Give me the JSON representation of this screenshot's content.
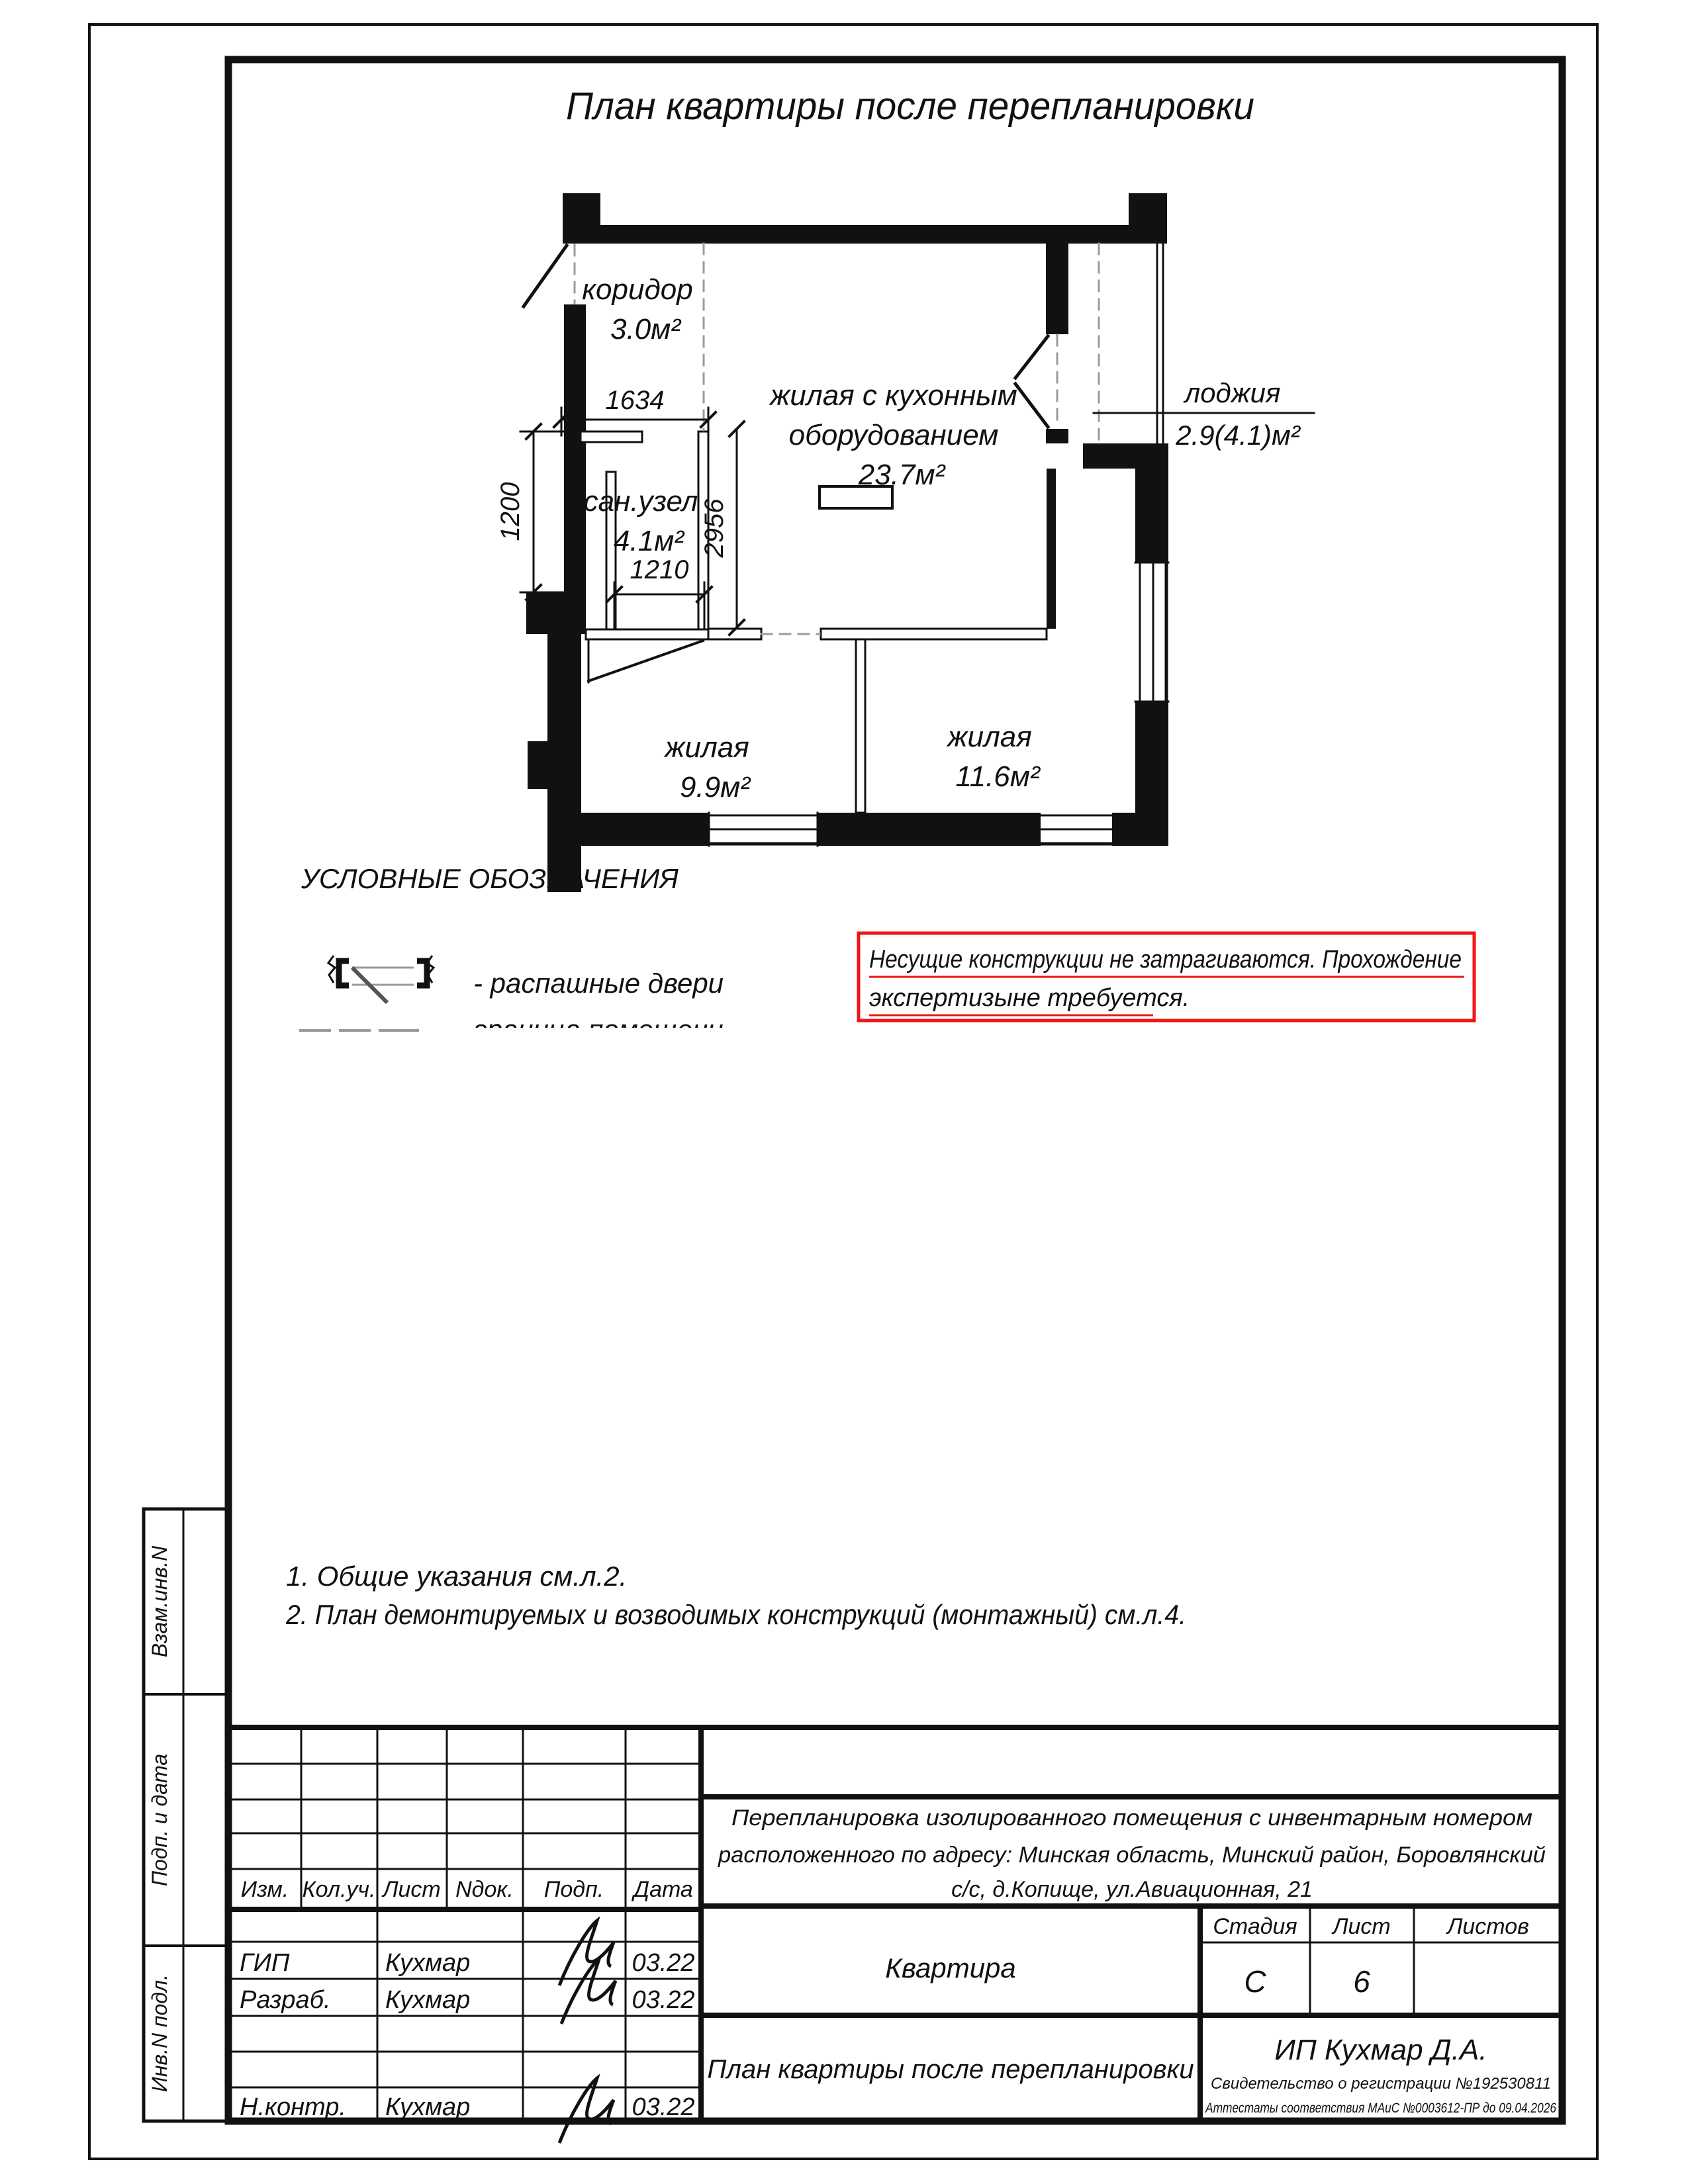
{
  "page": {
    "title": "План квартиры после перепланировки"
  },
  "plan": {
    "rooms": {
      "koridor": {
        "name": "коридор",
        "area": "3.0м²"
      },
      "sanuzel": {
        "name": "сан.узел",
        "area": "4.1м²"
      },
      "kitchen": {
        "line1": "жилая с кухонным",
        "line2": "оборудованием",
        "area": "23.7м²"
      },
      "loggia": {
        "name": "лоджия",
        "area": "2.9(4.1)м²"
      },
      "room1": {
        "name": "жилая",
        "area": "9.9м²"
      },
      "room2": {
        "name": "жилая",
        "area": "11.6м²"
      }
    },
    "dimensions": {
      "d1634": "1634",
      "d1200": "1200",
      "d2956": "2956",
      "d1210": "1210"
    }
  },
  "legend": {
    "title": "УСЛОВНЫЕ ОБОЗНАЧЕНИЯ",
    "item_doors": "- распашные двери",
    "item_boundary": "граница помещени"
  },
  "red_note": {
    "line1": "Несущие конструкции не затрагиваются. Прохождение",
    "line2": "экспертизыне требуется."
  },
  "notes": {
    "n1": "1. Общие указания см.л.2.",
    "n2": "2. План демонтируемых и возводимых конструкций (монтажный) см.л.4."
  },
  "sidebar": {
    "labels": [
      "Взам.инв.N",
      "Подп. и дата",
      "Инв.N подл."
    ]
  },
  "titleblock": {
    "headers": {
      "izm": "Изм.",
      "kol": "Кол.уч.",
      "list": "Лист",
      "ndok": "Nдок.",
      "podp": "Подп.",
      "data": "Дата"
    },
    "rows": {
      "gip": {
        "role": "ГИП",
        "name": "Кухмар",
        "date": "03.22"
      },
      "razrab": {
        "role": "Разраб.",
        "name": "Кухмар",
        "date": "03.22"
      },
      "nkontr": {
        "role": "Н.контр.",
        "name": "Кухмар",
        "date": "03.22"
      }
    },
    "project_line1": "Перепланировка изолированного помещения с инвентарным номером",
    "project_line2": "расположенного по адресу: Минская область, Минский район, Боровлянский",
    "project_line3": "с/с, д.Копище, ул.Авиационная, 21",
    "object": "Квартира",
    "stage_header": "Стадия",
    "sheet_header": "Лист",
    "sheets_header": "Листов",
    "stage": "С",
    "sheet": "6",
    "sheet_title": "План квартиры после перепланировки",
    "company": "ИП Кухмар Д.А.",
    "cert1": "Свидетельство о регистрации №192530811",
    "cert2": "Аттестаты соответствия МАиС №0003612-ПР до 09.04.2026"
  }
}
